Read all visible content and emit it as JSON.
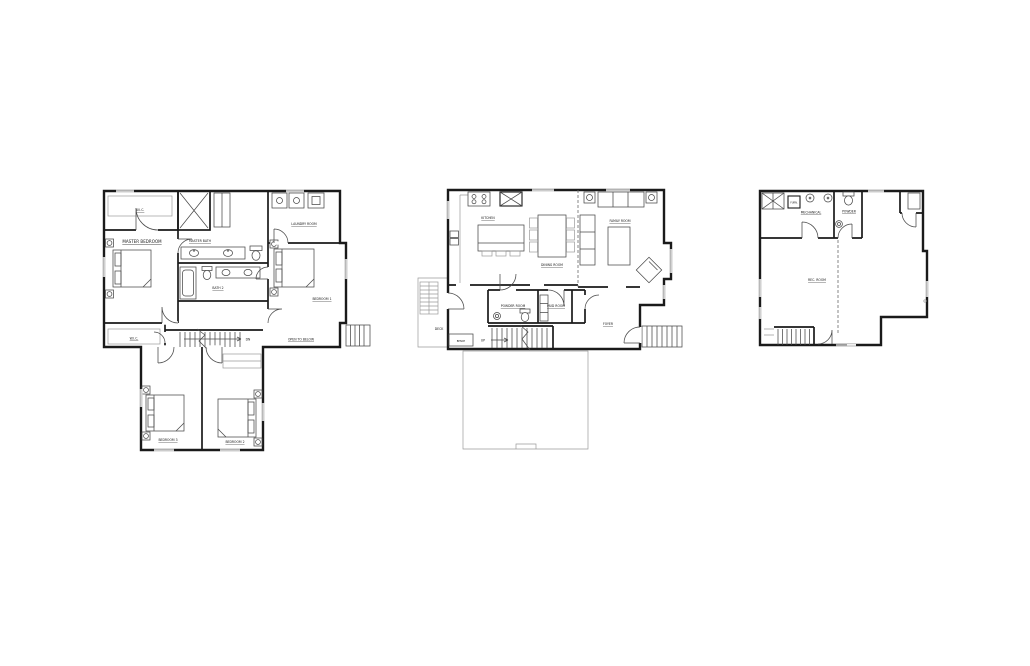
{
  "colors": {
    "background": "#ffffff",
    "wall": "#1a1a1a",
    "fixture": "#4a4a4a",
    "light_line": "#9a9a9a"
  },
  "plans": {
    "upper": {
      "labels": {
        "wic_top": "W.I.C.",
        "master_bedroom": "MASTER BEDROOM",
        "master_bath": "MASTER BATH",
        "laundry_room": "LAUNDRY ROOM",
        "bath_2": "BATH 2",
        "bedroom_1": "BEDROOM 1",
        "wic_bottom": "W.I.C.",
        "stairs_dn": "DN",
        "open_to_below": "OPEN TO BELOW",
        "bedroom_3": "BEDROOM 3",
        "bedroom_2": "BEDROOM 2"
      }
    },
    "main": {
      "labels": {
        "kitchen": "KITCHEN",
        "dining_room": "DINING ROOM",
        "family_room": "FAMILY ROOM",
        "powder_room": "POWDER ROOM",
        "mud_room": "MUD ROOM",
        "foyer": "FOYER",
        "deck": "DECK",
        "bench": "BENCH",
        "stairs_up": "UP"
      }
    },
    "basement": {
      "labels": {
        "furnace": "FURN.",
        "mechanical": "MECHANICAL",
        "powder": "POWDER",
        "rec_room": "REC. ROOM"
      }
    }
  }
}
